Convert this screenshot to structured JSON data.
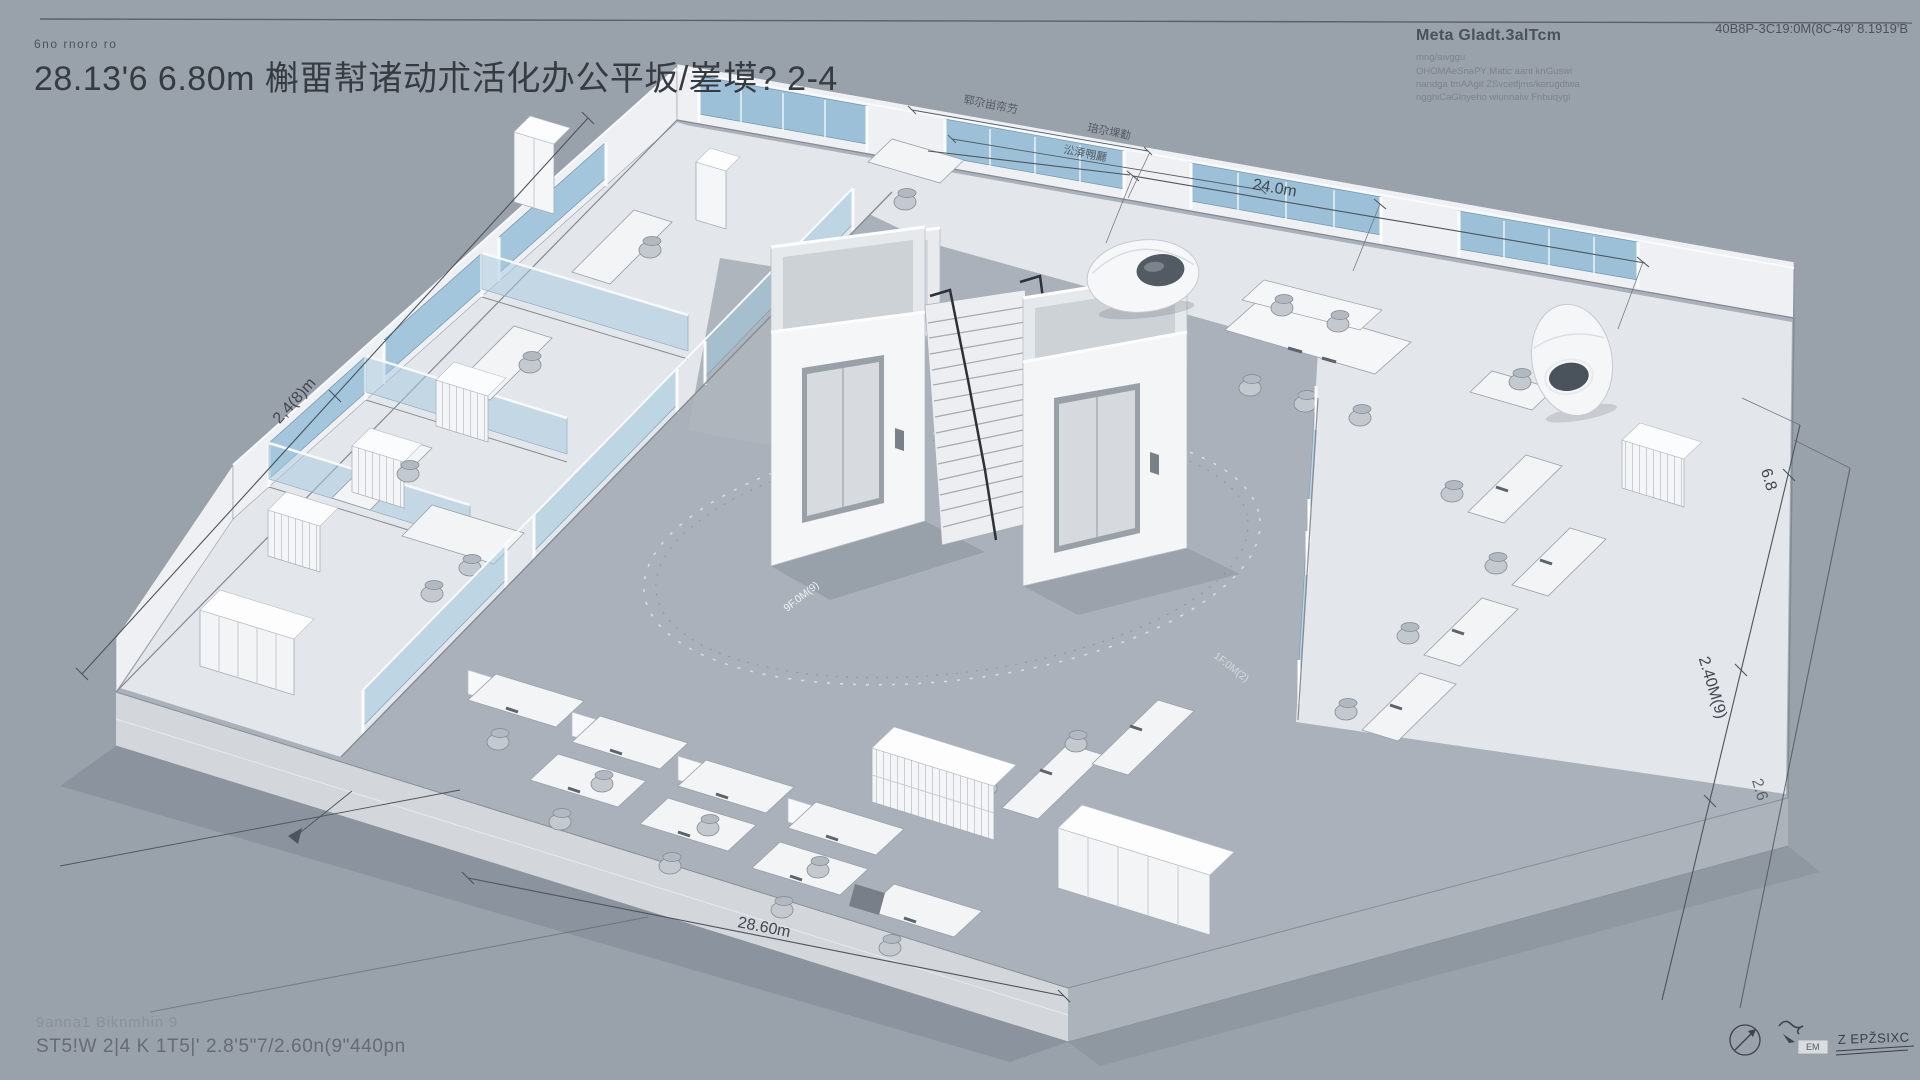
{
  "page": {
    "background": "#99a1ab"
  },
  "header": {
    "eyebrow": "6no rnoro ro",
    "title": "28.13'6 6.80m 槲畱幇诸动朮活化办公平坂/嵳塻? 2-4",
    "corner_note": "40B8P-3C19:0M(8C-49' 8.1919'B"
  },
  "meta_block": {
    "heading": "Meta Gladt.3alTcm",
    "lines": [
      "mng/awggu",
      "OHOMAeSnaPY Matic aant knGuswi",
      "nandga tmAAgit ZSvcetfjms/kerugdtwa",
      "ngghiCaGlnyeho wiunnaiw Fnbuqygi"
    ]
  },
  "drawing": {
    "dimensions": {
      "top": "24.0m",
      "bottom": "28.60m",
      "left": "2,4(8)m",
      "right_upper": "6.8",
      "right_mid": "2.40M(9)",
      "right_lower": "2.6",
      "note_a": "郓尕畄帟芀",
      "note_b": "琣尕堁㔤",
      "note_c": "㳂㴁翈㕔",
      "circle_left": "9F.0M(9)",
      "circle_right": "1F.0M(2)"
    },
    "colors": {
      "glass": "#9cc0d7",
      "wall": "#eef0f3",
      "room_floor": "#e3e6ea",
      "slab": "#aab1ba",
      "line": "#4e545c"
    }
  },
  "footer": {
    "line1": "9anna1 Biknmhin 9",
    "line2": "ST5!W 2|4 K 1T5|' 2.8'5\"7/2.60n(9\"440pn"
  },
  "signature": {
    "box_label": "EM",
    "text": "Z EPŽSIXC"
  }
}
